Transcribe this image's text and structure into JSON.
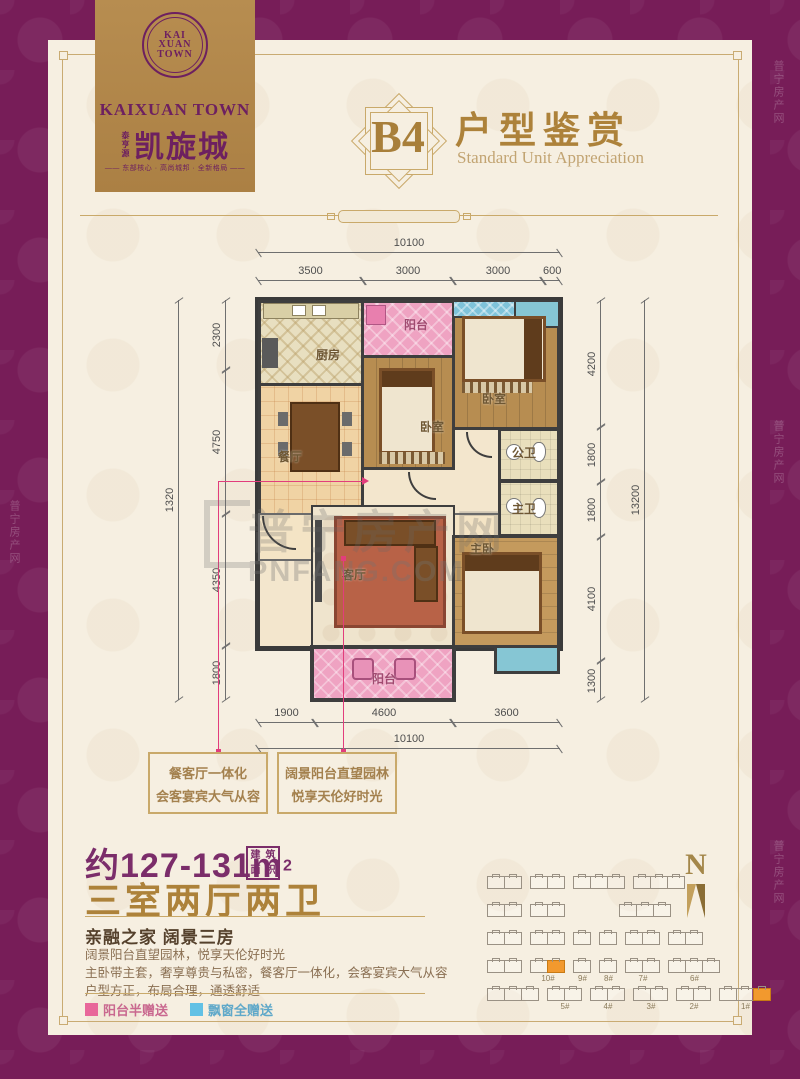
{
  "page": {
    "watermark_cn": "普宁房产网",
    "watermark_en": "PNFANG.COM"
  },
  "logo": {
    "monogram": [
      "KAI",
      "XUAN",
      "TOWN"
    ],
    "brand_en": "KAIXUAN TOWN",
    "brand_side": "泰亨源",
    "brand_cn": "凯旋城",
    "tagline": "—— 东部核心 · 高尚城邦 · 全新格局 ——"
  },
  "header": {
    "badge": "B4",
    "title": "户型鉴赏",
    "subtitle": "Standard Unit Appreciation"
  },
  "floorplan": {
    "rooms": {
      "kitchen": "厨房",
      "balcony_top": "阳台",
      "bedroom1": "卧室",
      "bedroom2": "卧室",
      "dining": "餐厅",
      "living": "客厅",
      "bath_public": "公卫",
      "bath_master": "主卫",
      "master": "主卧",
      "balcony_bottom": "阳台"
    },
    "dims": {
      "top_total": "10100",
      "top": [
        "3500",
        "3000",
        "3000",
        "600"
      ],
      "bottom": [
        "1900",
        "4600",
        "3600"
      ],
      "bottom_total": "10100",
      "left_total": "1320",
      "left": [
        "2300",
        "4750",
        "4350",
        "1800"
      ],
      "right": [
        "4200",
        "1800",
        "1800",
        "4100",
        "1300"
      ],
      "right_total": "13200"
    }
  },
  "callouts": [
    {
      "line1": "餐客厅一体化",
      "line2": "会客宴宾大气从容"
    },
    {
      "line1": "阔景阳台直望园林",
      "line2": "悦享天伦好时光"
    }
  ],
  "summary": {
    "area_prefix": "约",
    "area_value": "127-131",
    "area_unit": "m",
    "area_sup": "2",
    "area_seal_1": "建",
    "area_seal_2": "筑",
    "area_seal_3": "面",
    "area_seal_4": "积",
    "layout": "三室两厅两卫",
    "heading": "亲融之家  阔景三房",
    "lines": [
      "阔景阳台直望园林，悦享天伦好时光",
      "主卧带主套，奢享尊贵与私密，餐客厅一体化，会客宴宾大气从容",
      "户型方正，布局合理，通透舒适"
    ]
  },
  "legend": [
    {
      "label": "阳台半赠送",
      "color": "#e8679a",
      "text_color": "#c9688f"
    },
    {
      "label": "飘窗全赠送",
      "color": "#62c1e5",
      "text_color": "#5fa8c9"
    }
  ],
  "siteplan": {
    "north": "N",
    "rows": [
      [
        {
          "u": 2
        },
        {
          "u": 2
        },
        {
          "u": 3
        },
        {
          "u": 3
        }
      ],
      [
        {
          "u": 2
        },
        {
          "u": 2
        },
        {
          "u": 0
        },
        {
          "u": 0
        },
        {
          "u": 3
        }
      ],
      [
        {
          "u": 2
        },
        {
          "u": 2
        },
        {
          "u": 1
        },
        {
          "u": 1
        },
        {
          "u": 2
        },
        {
          "u": 2
        }
      ],
      [
        {
          "u": 2
        },
        {
          "u": 2,
          "label": "10#",
          "hl": 1
        },
        {
          "u": 1,
          "label": "9#"
        },
        {
          "u": 1,
          "label": "8#"
        },
        {
          "u": 2,
          "label": "7#"
        },
        {
          "u": 3,
          "label": "6#"
        }
      ],
      [
        {
          "u": 3
        },
        {
          "u": 2,
          "label": "5#"
        },
        {
          "u": 2,
          "label": "4#"
        },
        {
          "u": 2,
          "label": "3#"
        },
        {
          "u": 2,
          "label": "2#"
        },
        {
          "u": 3,
          "label": "1#",
          "hl": 2
        }
      ]
    ]
  },
  "colors": {
    "border_purple": "#771d58",
    "panel_cream": "#f6efe1",
    "gold": "#c9a96a",
    "title_gold": "#ad823a",
    "brand_purple": "#6d2060",
    "area_purple": "#7b2d6a",
    "balcony_pink": "#efa3c2",
    "bay_blue": "#7fc3da",
    "highlight_orange": "#f2992e",
    "callout_line_pink": "#e23d7c"
  }
}
